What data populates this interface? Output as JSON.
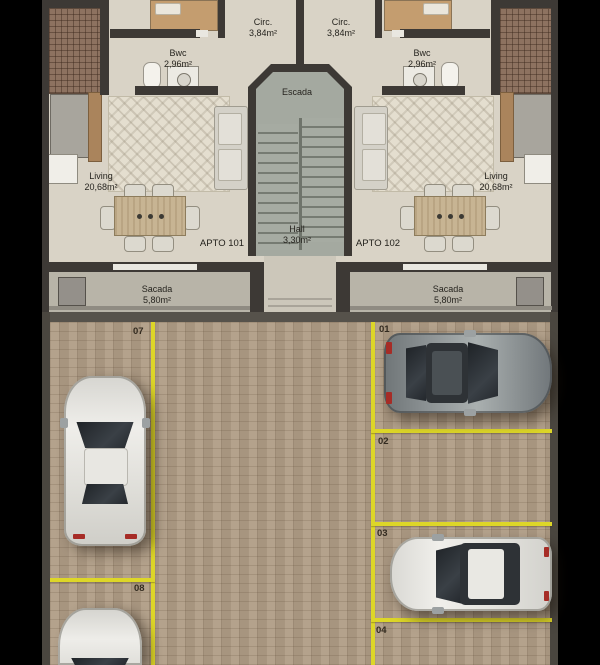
{
  "floorplan": {
    "apartments": [
      {
        "label": "APTO 101"
      },
      {
        "label": "APTO 102"
      }
    ],
    "rooms": {
      "circ_left": {
        "name": "Circ.",
        "area": "3,84m²"
      },
      "circ_right": {
        "name": "Circ.",
        "area": "3,84m²"
      },
      "bwc_left": {
        "name": "Bwc",
        "area": "2,96m²"
      },
      "bwc_right": {
        "name": "Bwc",
        "area": "2,96m²"
      },
      "living_left": {
        "name": "Living",
        "area": "20,68m²"
      },
      "living_right": {
        "name": "Living",
        "area": "20,68m²"
      },
      "escada": {
        "name": "Escada"
      },
      "hall": {
        "name": "Hall",
        "area": "3,30m²"
      },
      "sacada_left": {
        "name": "Sacada",
        "area": "5,80m²"
      },
      "sacada_right": {
        "name": "Sacada",
        "area": "5,80m²"
      }
    }
  },
  "parking": {
    "spaces": [
      {
        "number": "01",
        "occupied": true,
        "vehicle": "gray-car"
      },
      {
        "number": "02",
        "occupied": false,
        "vehicle": null
      },
      {
        "number": "03",
        "occupied": true,
        "vehicle": "silver-car"
      },
      {
        "number": "04",
        "occupied": false,
        "vehicle": null
      },
      {
        "number": "07",
        "occupied": true,
        "vehicle": "white-car"
      },
      {
        "number": "08",
        "occupied": true,
        "vehicle": "white-car-partial"
      }
    ],
    "line_color": "#ddd628"
  },
  "colors": {
    "background": "#000000",
    "plan_floor": "#d9d3c6",
    "wall": "#3d3935",
    "sacada_floor": "#b8b4a8",
    "stair_floor": "#a4a9a0",
    "paver": "#b09d86",
    "parking_line": "#ddd628",
    "mosaic_tile": "#8d7260"
  }
}
